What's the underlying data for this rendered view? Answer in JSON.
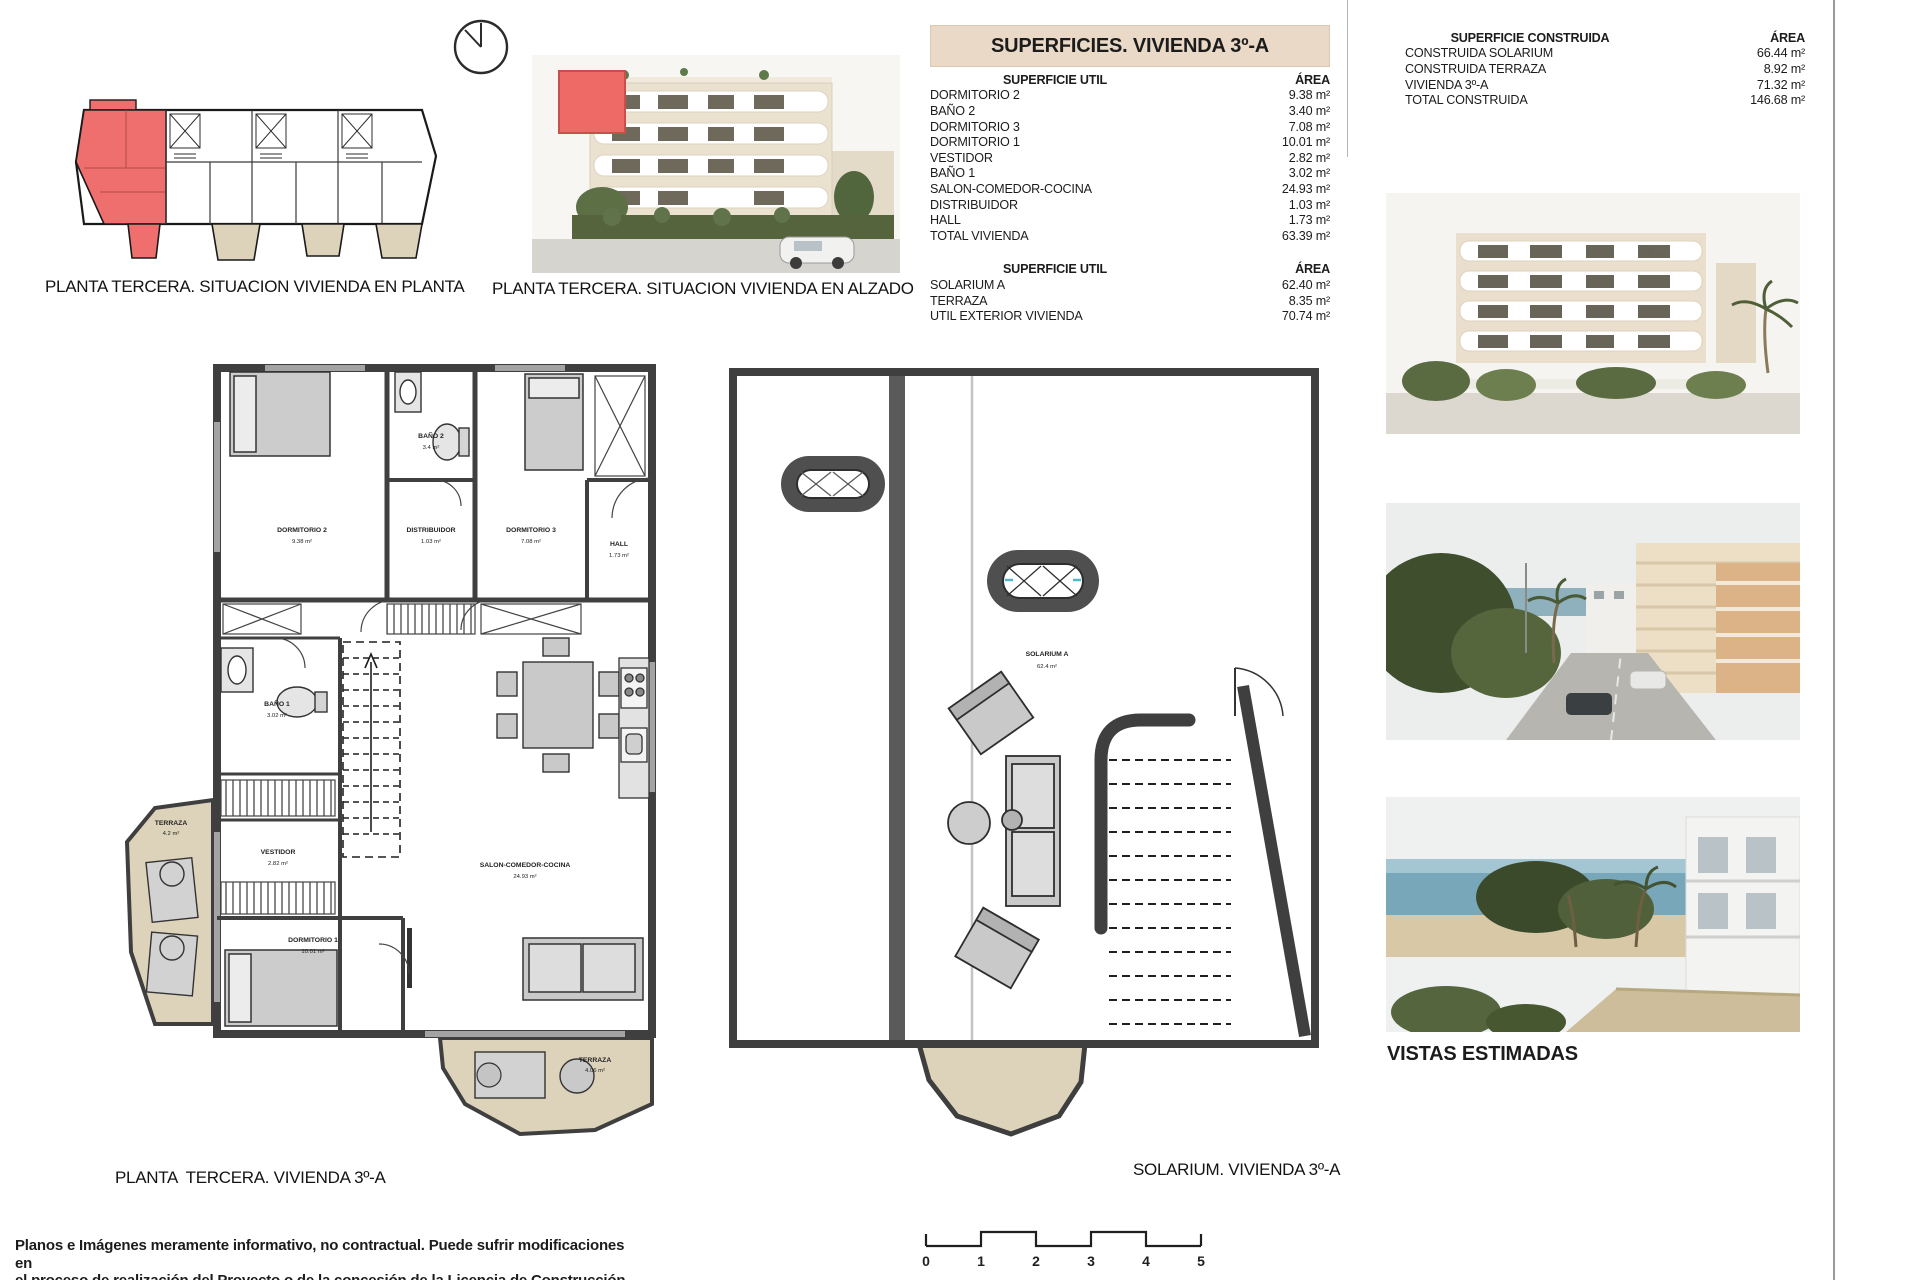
{
  "captions": {
    "overview": "PLANTA TERCERA. SITUACION VIVIENDA EN PLANTA",
    "elevation": "PLANTA TERCERA. SITUACION VIVIENDA EN ALZADO",
    "floor_plan": "PLANTA  TERCERA. VIVIENDA 3º-A",
    "solarium": "SOLARIUM. VIVIENDA 3º-A",
    "views": "VISTAS ESTIMADAS"
  },
  "surfaces_table": {
    "title": "SUPERFICIES. VIVIENDA 3º-A",
    "headers": {
      "label": "SUPERFICIE UTIL",
      "area": "ÁREA"
    },
    "util_rows": [
      [
        "DORMITORIO 2",
        "9.38 m²"
      ],
      [
        "BAÑO 2",
        "3.40 m²"
      ],
      [
        "DORMITORIO 3",
        "7.08 m²"
      ],
      [
        "DORMITORIO 1",
        "10.01 m²"
      ],
      [
        "VESTIDOR",
        "2.82 m²"
      ],
      [
        "BAÑO 1",
        "3.02 m²"
      ],
      [
        "SALON-COMEDOR-COCINA",
        "24.93 m²"
      ],
      [
        "DISTRIBUIDOR",
        "1.03 m²"
      ],
      [
        "HALL",
        "1.73 m²"
      ],
      [
        "TOTAL VIVIENDA",
        "63.39 m²"
      ]
    ],
    "exterior_rows": [
      [
        "SOLARIUM A",
        "62.40 m²"
      ],
      [
        "TERRAZA",
        "8.35 m²"
      ],
      [
        "UTIL EXTERIOR VIVIENDA",
        "70.74 m²"
      ]
    ]
  },
  "built_table": {
    "headers": {
      "label": "SUPERFICIE CONSTRUIDA",
      "area": "ÁREA"
    },
    "rows": [
      [
        "CONSTRUIDA SOLARIUM",
        "66.44 m²"
      ],
      [
        "CONSTRUIDA TERRAZA",
        "8.92 m²"
      ],
      [
        "VIVIENDA 3º-A",
        "71.32 m²"
      ],
      [
        "TOTAL CONSTRUIDA",
        "146.68 m²"
      ]
    ]
  },
  "floor_plan": {
    "rooms": {
      "dorm2": {
        "name": "DORMITORIO 2",
        "area": "9.38 m²"
      },
      "bano2": {
        "name": "BAÑO 2",
        "area": "3.4 m²"
      },
      "distribuidor": {
        "name": "DISTRIBUIDOR",
        "area": "1.03 m²"
      },
      "dorm3": {
        "name": "DORMITORIO 3",
        "area": "7.08 m²"
      },
      "hall": {
        "name": "HALL",
        "area": "1.73 m²"
      },
      "bano1": {
        "name": "BAÑO 1",
        "area": "3.02 m²"
      },
      "vestidor": {
        "name": "VESTIDOR",
        "area": "2.82 m²"
      },
      "dorm1": {
        "name": "DORMITORIO 1",
        "area": "10.01 m²"
      },
      "salon": {
        "name": "SALON-COMEDOR-COCINA",
        "area": "24.93 m²"
      },
      "terraza_left": {
        "name": "TERRAZA",
        "area": "4.2 m²"
      },
      "terraza_bottom": {
        "name": "TERRAZA",
        "area": "4.06 m²"
      }
    }
  },
  "solarium_plan": {
    "room": {
      "name": "SOLARIUM A",
      "area": "62.4 m²"
    }
  },
  "scale_bar": {
    "ticks": [
      "0",
      "1",
      "2",
      "3",
      "4",
      "5"
    ]
  },
  "disclaimer": {
    "line1": "Planos e Imágenes meramente informativo, no contractual. Puede sufrir modificaciones en",
    "line2": "el proceso de realización del Proyecto o de la concesión de la Licencia de Construcción."
  },
  "colors": {
    "highlight_red": "#ee6c66",
    "title_bar_beige": "#e9d9c6",
    "terrace_beige": "#ddd3ba",
    "wall_gray": "#3f3f3f"
  }
}
